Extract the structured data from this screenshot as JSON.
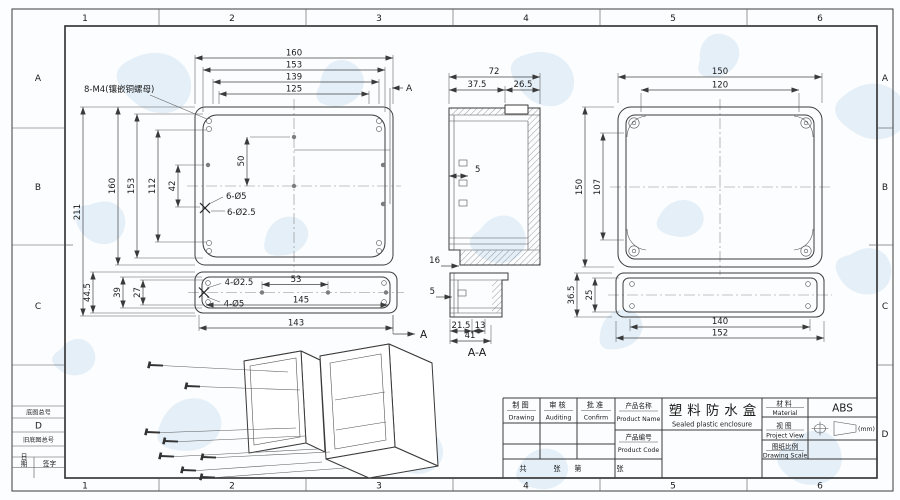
{
  "border": {
    "col_labels": [
      "1",
      "2",
      "3",
      "4",
      "5",
      "6"
    ],
    "row_labels": [
      "A",
      "B",
      "C",
      "D"
    ],
    "stamp": {
      "base_no": "底图总号",
      "zone": "D",
      "old_base_no": "旧底图总号",
      "date": "日期",
      "signature": "签字"
    }
  },
  "views": {
    "base": {
      "note": "8-M4(镶嵌铜螺母)",
      "dims_top": [
        "160",
        "153",
        "139",
        "125"
      ],
      "dims_left": [
        "211",
        "160",
        "153",
        "112",
        "42"
      ],
      "dim_vertical": "50",
      "hole_label_1": "6-Ø5",
      "hole_label_2": "6-Ø2.5",
      "section_mark": "A"
    },
    "base_strip": {
      "dims_left": [
        "44.5",
        "39",
        "27"
      ],
      "hole_label_1": "4-Ø2.5",
      "hole_label_2": "4-Ø5",
      "dim_53": "53",
      "dim_145": "145",
      "dim_143": "143",
      "section_mark": "A"
    },
    "section": {
      "label": "A-A",
      "dim_72": "72",
      "dim_375": "37.5",
      "dim_265": "26.5",
      "dim_5a": "5",
      "dim_16": "16",
      "dim_5b": "5",
      "dim_215": "21.5",
      "dim_13": "13",
      "dim_41": "41"
    },
    "cover": {
      "dim_150t": "150",
      "dim_120": "120",
      "dim_150l": "150",
      "dim_107": "107",
      "dim_365": "36.5",
      "dim_25": "25",
      "dim_140": "140",
      "dim_152": "152"
    }
  },
  "title_block": {
    "drawing_cn": "制图",
    "drawing_en": "Drawing",
    "auditing_cn": "审核",
    "auditing_en": "Auditing",
    "confirm_cn": "批准",
    "confirm_en": "Confirm",
    "product_name_cn": "产品名称",
    "product_name_en": "Product Name",
    "product_code_cn": "产品编号",
    "product_code_en": "Product Code",
    "product_title_cn": "塑料防水盒",
    "product_title_en": "Sealed plastic enclosure",
    "material_cn": "材料",
    "material_en": "Material",
    "material_value": "ABS",
    "view_cn": "视图",
    "view_en": "Project View",
    "scale_cn": "图纸比例",
    "scale_en": "Drawing Scale",
    "unit": "(mm)",
    "sheet_total_cn": "共",
    "sheet_cn": "张",
    "sheet_no_cn": "第",
    "sheet_cn2": "张"
  }
}
